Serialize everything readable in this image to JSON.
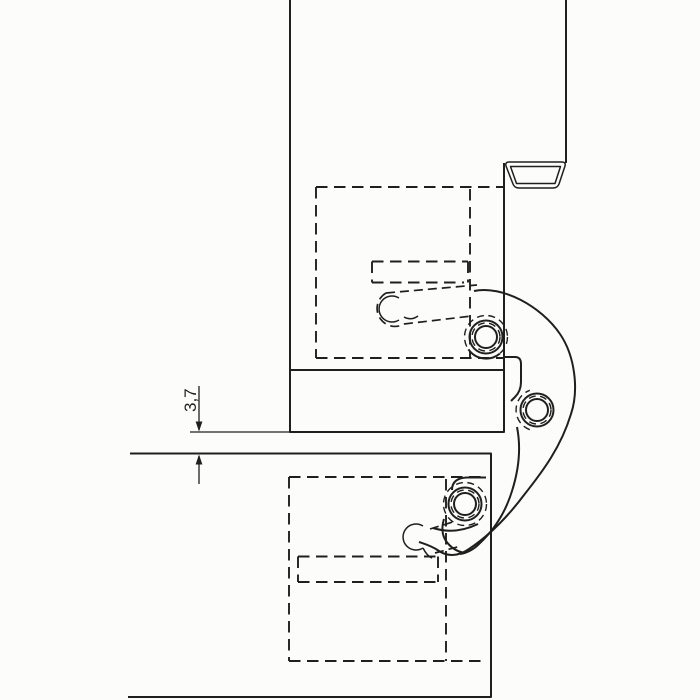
{
  "drawing": {
    "type": "technical-section-drawing",
    "subject": "concealed-hinge-between-frame-and-door-leaf",
    "dimension": {
      "label": "3,7",
      "value": 3.7
    },
    "colors": {
      "background": "#fcfdfa",
      "line": "#1f1f1f"
    }
  }
}
